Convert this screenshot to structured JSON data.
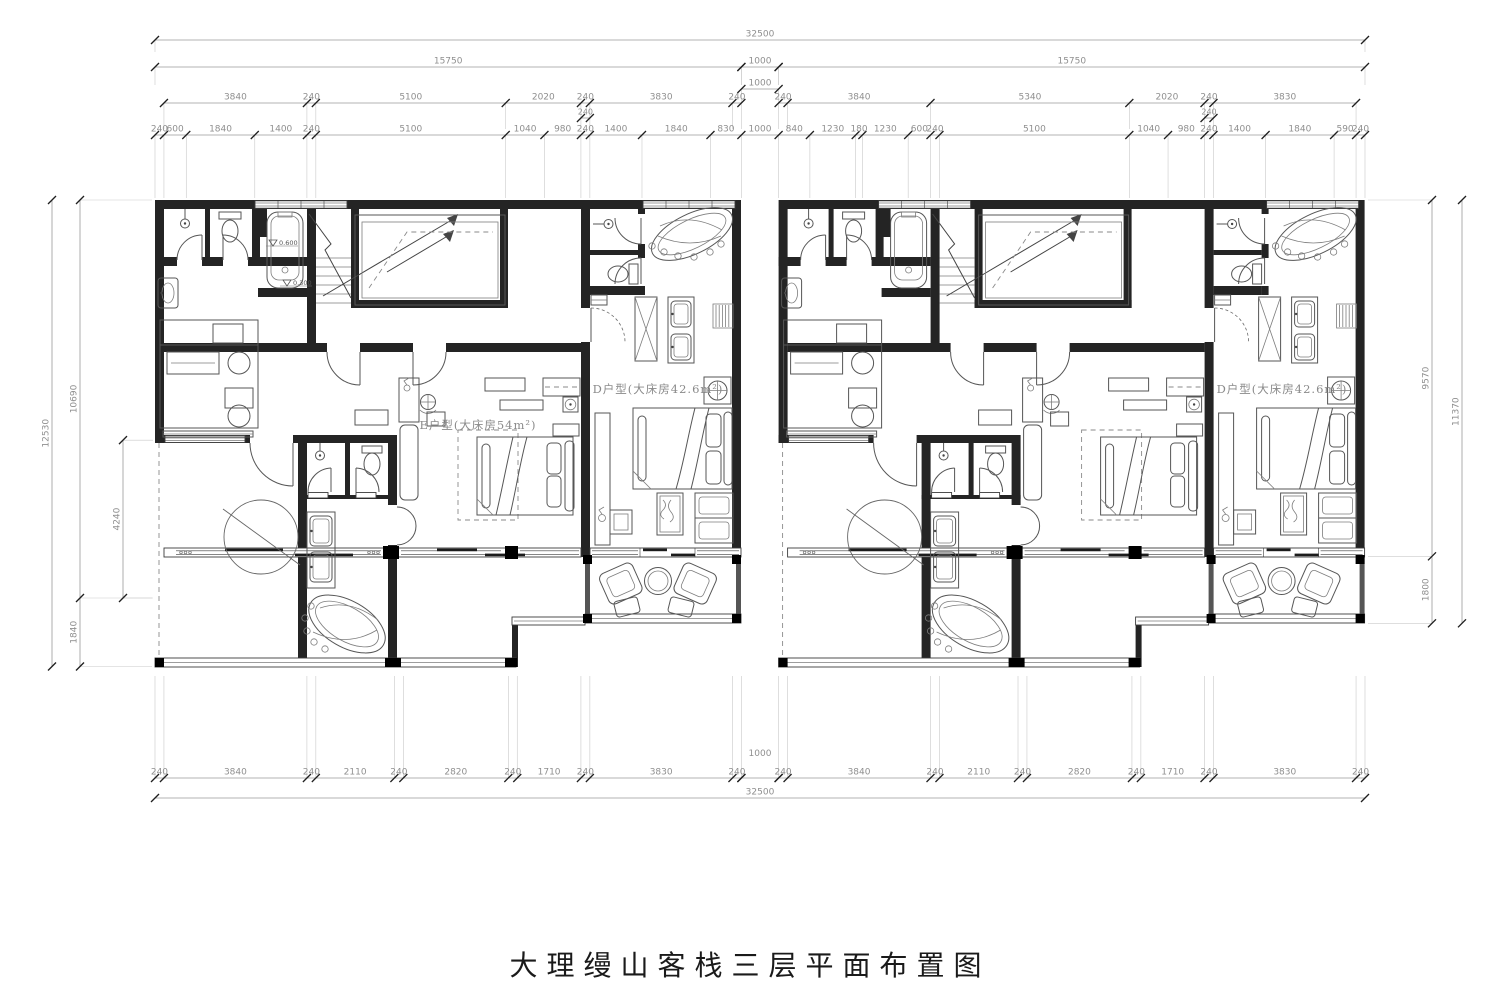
{
  "title": "大理缦山客栈三层平面布置图",
  "rooms": {
    "unit_left_e": "E户型(大床房54m²)",
    "unit_left_d": "D户型(大床房42.6m²)",
    "unit_right_d": "D户型(大床房42.6m²)"
  },
  "levels": {
    "tub_upper": "0.600",
    "tub_lower": "0.300"
  },
  "dims": {
    "t1": [
      "32500"
    ],
    "t2l": [
      "15750"
    ],
    "t2g": [
      "1000"
    ],
    "t2g2": [
      "1000"
    ],
    "t2r": [
      "15750"
    ],
    "t3l": [
      "3840",
      "240",
      "5100",
      "2020",
      "240",
      "3830",
      "240"
    ],
    "t3r": [
      "240",
      "3840",
      "5340",
      "2020",
      "240",
      "3830"
    ],
    "t35l": [
      "240"
    ],
    "t35r": [
      "240"
    ],
    "t4": [
      "240",
      "600",
      "1840",
      "1400",
      "240",
      "5100",
      "1040",
      "980",
      "240",
      "1400",
      "1840",
      "830",
      "1000",
      "840",
      "1230",
      "180",
      "1230",
      "600",
      "240",
      "5100",
      "1040",
      "980",
      "240",
      "1400",
      "1840",
      "590",
      "240"
    ],
    "b1l": [
      "240",
      "3840",
      "240",
      "2110",
      "240",
      "2820",
      "240",
      "1710",
      "240",
      "3830",
      "240"
    ],
    "b1g": [
      "1000"
    ],
    "b1r": [
      "240",
      "3840",
      "240",
      "2110",
      "240",
      "2820",
      "240",
      "1710",
      "240",
      "3830",
      "240"
    ],
    "b2": [
      "32500"
    ],
    "lv1": [
      "12530"
    ],
    "lv2": [
      "10690",
      "1840"
    ],
    "lv3": [
      "4240"
    ],
    "rv1": [
      "9570",
      "1800"
    ],
    "rv2": [
      "11370"
    ]
  }
}
